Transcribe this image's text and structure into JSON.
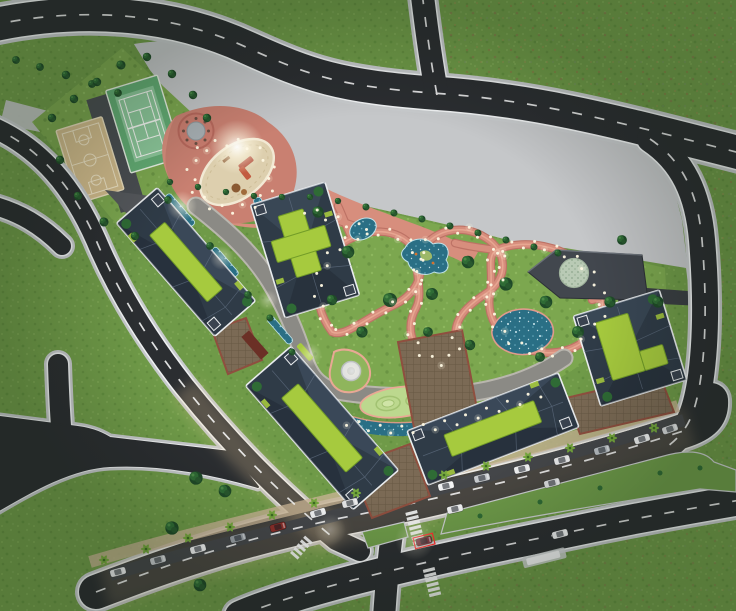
{
  "scene": {
    "kind": "architectural-masterplan-aerial-rendering",
    "canvas": {
      "width": 736,
      "height": 611
    },
    "features": [
      "grass",
      "roads",
      "basketball-court",
      "tennis-court",
      "playground",
      "central-park",
      "ponds",
      "apartment-buildings",
      "green-roofs",
      "clubhouse",
      "boulevard",
      "parked-cars",
      "palm-trees",
      "crosswalks",
      "path-lights"
    ]
  },
  "palette": {
    "grass": "#6f9a48",
    "grassLight": "#7fa855",
    "parkGrass": "#7ca74f",
    "mottle": "#8a7a45",
    "plaza": "#c5c7c9",
    "plazaDark": "#b3b5b7",
    "asphalt": "#2b2e31",
    "asphaltLight": "#55565a",
    "walkway": "#8b8a85",
    "curb": "#c7cacc",
    "lineWhite": "#eff1f2",
    "pink": "#d78e7d",
    "pinkDark": "#bd7265",
    "pinkLight": "#e9a894",
    "playground": "#c98071",
    "sand": "#ddcfae",
    "sandEdge": "#f2e9d4",
    "water": "#2a6f85",
    "waterLight": "#6fb3c6",
    "sparkle": "#dff4f8",
    "lime": "#a6ca3e",
    "limeDark": "#729c28",
    "roof": "#2f3b47",
    "roofLight": "#49596c",
    "roofDark": "#1e2630",
    "roofOutline": "#e9ecee",
    "treeDark": "#1f4a28",
    "treeMid": "#2f6b35",
    "treeHi": "#4b8a47",
    "palm": "#76a83e",
    "courtyard": "#7b6a55",
    "courtyardLine": "#8f4f3f",
    "clubhouse": "#42474e",
    "clubRoof": "#b9cab5",
    "clubRoofDot": "#8fa78d",
    "courtTan": "#d2bc8d",
    "courtLineTan": "#efe4c6",
    "courtGreen": "#8cc79a",
    "courtGreenDark": "#63ac74",
    "median": "#6f9c4a",
    "sidewalkWarm": "#c9b595",
    "glowWarm": "#e8c99a",
    "light": "#fff9e3"
  },
  "lights": {
    "spacing": 11,
    "radius": 1.5,
    "sideOffset": 3.5,
    "max": 320
  },
  "trees": [
    [
      16,
      60,
      0.55
    ],
    [
      40,
      67,
      0.55
    ],
    [
      66,
      75,
      0.6
    ],
    [
      92,
      84,
      0.55
    ],
    [
      118,
      93,
      0.55
    ],
    [
      52,
      118,
      0.6
    ],
    [
      74,
      99,
      0.6
    ],
    [
      97,
      82,
      0.6
    ],
    [
      121,
      65,
      0.65
    ],
    [
      147,
      57,
      0.6
    ],
    [
      172,
      74,
      0.6
    ],
    [
      193,
      95,
      0.6
    ],
    [
      207,
      118,
      0.6
    ],
    [
      60,
      160,
      0.6
    ],
    [
      78,
      196,
      0.6
    ],
    [
      104,
      222,
      0.65
    ],
    [
      135,
      236,
      0.6
    ],
    [
      170,
      182,
      0.45
    ],
    [
      198,
      187,
      0.45
    ],
    [
      226,
      192,
      0.45
    ],
    [
      254,
      196,
      0.45
    ],
    [
      282,
      197,
      0.45
    ],
    [
      310,
      197,
      0.45
    ],
    [
      338,
      201,
      0.45
    ],
    [
      366,
      207,
      0.5
    ],
    [
      394,
      213,
      0.5
    ],
    [
      422,
      219,
      0.5
    ],
    [
      450,
      226,
      0.5
    ],
    [
      478,
      233,
      0.5
    ],
    [
      506,
      240,
      0.5
    ],
    [
      534,
      247,
      0.5
    ],
    [
      558,
      253,
      0.5
    ],
    [
      318,
      212,
      0.8
    ],
    [
      348,
      252,
      0.9
    ],
    [
      390,
      300,
      1.0
    ],
    [
      362,
      332,
      0.8
    ],
    [
      432,
      294,
      0.85
    ],
    [
      468,
      262,
      0.9
    ],
    [
      506,
      284,
      0.95
    ],
    [
      546,
      302,
      0.9
    ],
    [
      578,
      332,
      0.85
    ],
    [
      610,
      302,
      0.8
    ],
    [
      622,
      240,
      0.7
    ],
    [
      658,
      302,
      0.8
    ],
    [
      540,
      357,
      0.7
    ],
    [
      470,
      345,
      0.75
    ],
    [
      428,
      332,
      0.7
    ],
    [
      332,
      300,
      0.75
    ],
    [
      196,
      478,
      0.95
    ],
    [
      225,
      491,
      0.9
    ],
    [
      172,
      528,
      0.95
    ],
    [
      200,
      585,
      0.9
    ],
    [
      168,
      200,
      0.55
    ],
    [
      210,
      246,
      0.55
    ],
    [
      248,
      295,
      0.55
    ],
    [
      270,
      318,
      0.5
    ],
    [
      292,
      352,
      0.5
    ]
  ],
  "palms": [
    [
      104,
      560
    ],
    [
      146,
      549
    ],
    [
      188,
      538
    ],
    [
      230,
      527
    ],
    [
      272,
      515
    ],
    [
      314,
      503
    ],
    [
      356,
      493
    ],
    [
      444,
      475
    ],
    [
      486,
      466
    ],
    [
      528,
      457
    ],
    [
      570,
      448
    ],
    [
      612,
      438
    ],
    [
      654,
      428
    ]
  ],
  "parked_cars": [
    {
      "x": 118,
      "y": 572,
      "rot": -15,
      "color": "#e9eaeb"
    },
    {
      "x": 158,
      "y": 560,
      "rot": -15,
      "color": "#c9ccd0"
    },
    {
      "x": 198,
      "y": 549,
      "rot": -15,
      "color": "#f1f2f3"
    },
    {
      "x": 238,
      "y": 538,
      "rot": -15,
      "color": "#9aa0a6"
    },
    {
      "x": 278,
      "y": 527,
      "rot": -15,
      "color": "#8d2f2b"
    },
    {
      "x": 318,
      "y": 513,
      "rot": -16,
      "color": "#f1f2f3"
    },
    {
      "x": 350,
      "y": 503,
      "rot": -14,
      "color": "#e3e4e5"
    },
    {
      "x": 446,
      "y": 486,
      "rot": -13,
      "color": "#f1f2f3"
    },
    {
      "x": 482,
      "y": 478,
      "rot": -13,
      "color": "#c9ccd0"
    },
    {
      "x": 522,
      "y": 469,
      "rot": -13,
      "color": "#f1f2f3"
    },
    {
      "x": 562,
      "y": 460,
      "rot": -14,
      "color": "#ececed"
    },
    {
      "x": 602,
      "y": 450,
      "rot": -15,
      "color": "#b9bfc4"
    },
    {
      "x": 642,
      "y": 439,
      "rot": -17,
      "color": "#f1f2f3"
    },
    {
      "x": 670,
      "y": 429,
      "rot": -19,
      "color": "#d8dadc"
    }
  ],
  "moving_cars": [
    {
      "x": 455,
      "y": 509,
      "rot": -13,
      "color": "#f3f4f5"
    },
    {
      "x": 552,
      "y": 483,
      "rot": -14,
      "color": "#dfe1e2"
    },
    {
      "x": 560,
      "y": 534,
      "rot": -14,
      "color": "#eef0f1"
    },
    {
      "x": 424,
      "y": 541,
      "rot": -14,
      "color": "#6e2430",
      "highlight": true
    }
  ]
}
